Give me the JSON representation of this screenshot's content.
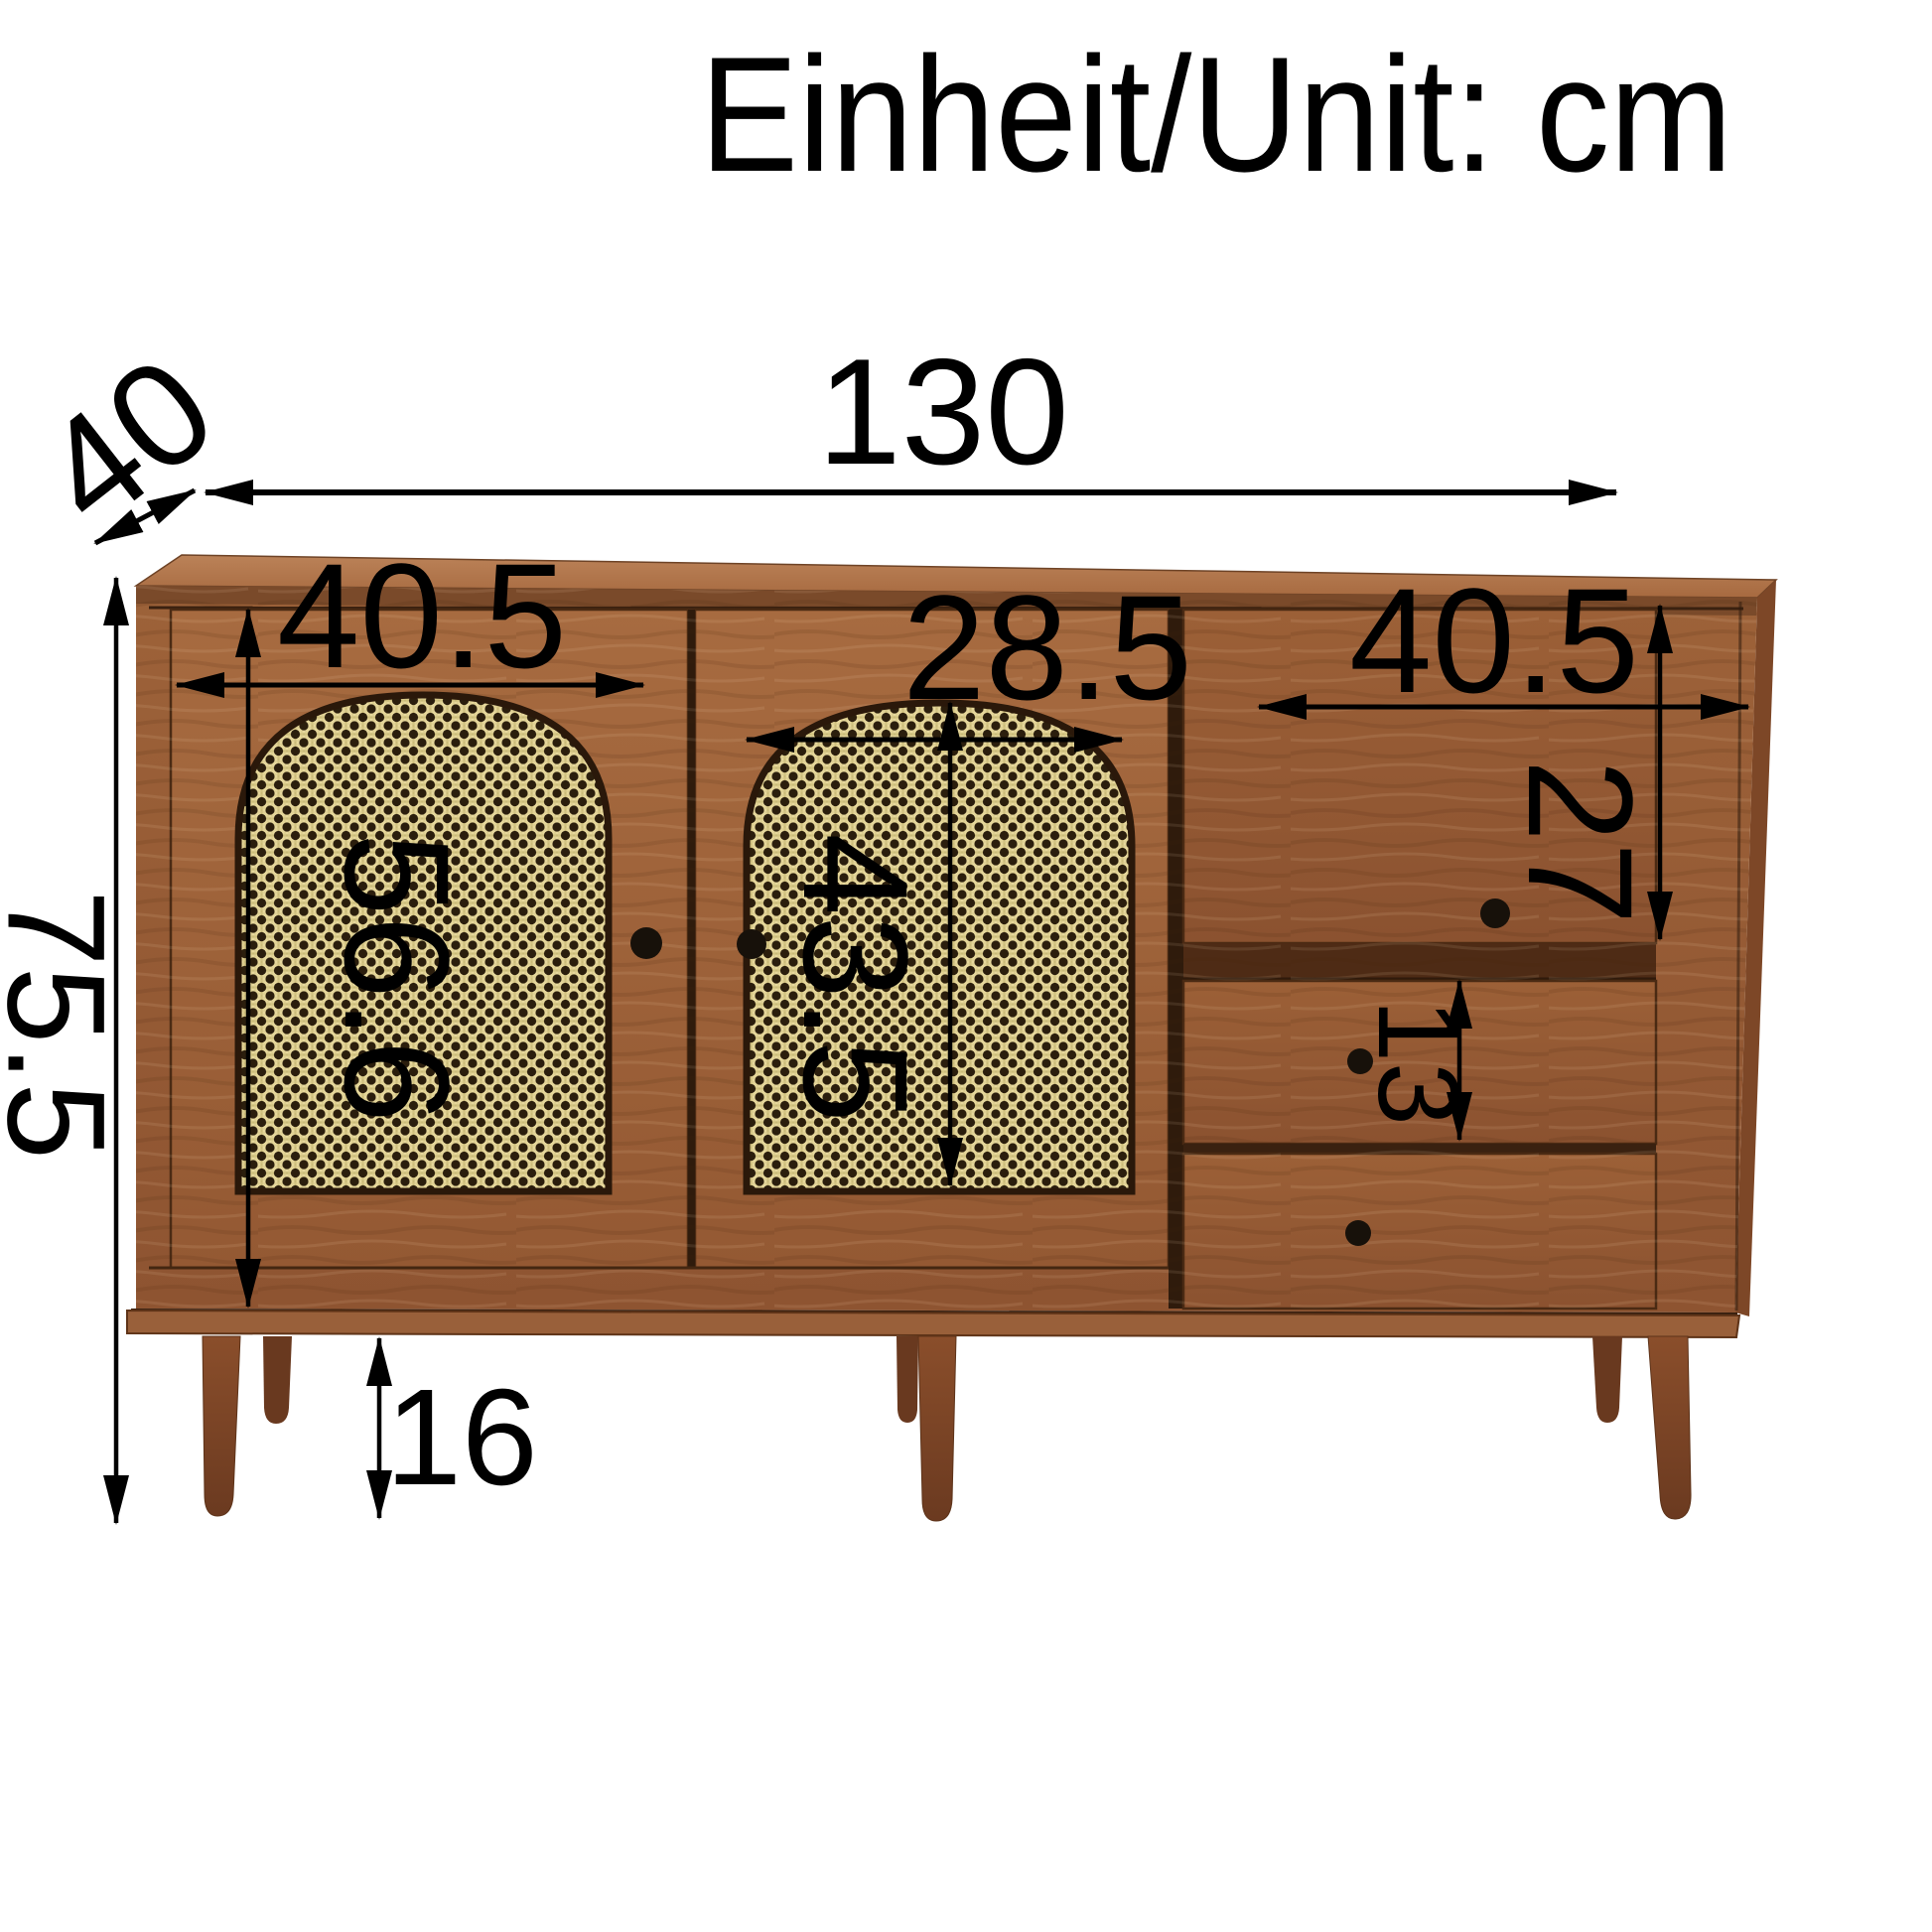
{
  "title": {
    "text": "Einheit/Unit: cm"
  },
  "unit": "cm",
  "dimensions": {
    "overall_width": {
      "value": "130"
    },
    "depth": {
      "value": "40"
    },
    "overall_height": {
      "value": "75.5"
    },
    "left_door_width": {
      "value": "40.5"
    },
    "left_door_height": {
      "value": "56.6"
    },
    "middle_door_panel_width": {
      "value": "28.5"
    },
    "middle_door_panel_height": {
      "value": "43.5"
    },
    "drawer_section_width": {
      "value": "40.5"
    },
    "top_drawer_height": {
      "value": "27"
    },
    "middle_drawer_height": {
      "value": "13"
    },
    "leg_height": {
      "value": "16"
    }
  },
  "colors": {
    "background": "#ffffff",
    "annotation": "#000000",
    "wood_top": "#b07347",
    "wood_front": "#9a5f37",
    "wood_door": "#a2673d",
    "wood_leg": "#7c4426",
    "cane_panel": "#e7d89c",
    "cane_dot": "#2b1e0d",
    "knob": "#17110a"
  }
}
